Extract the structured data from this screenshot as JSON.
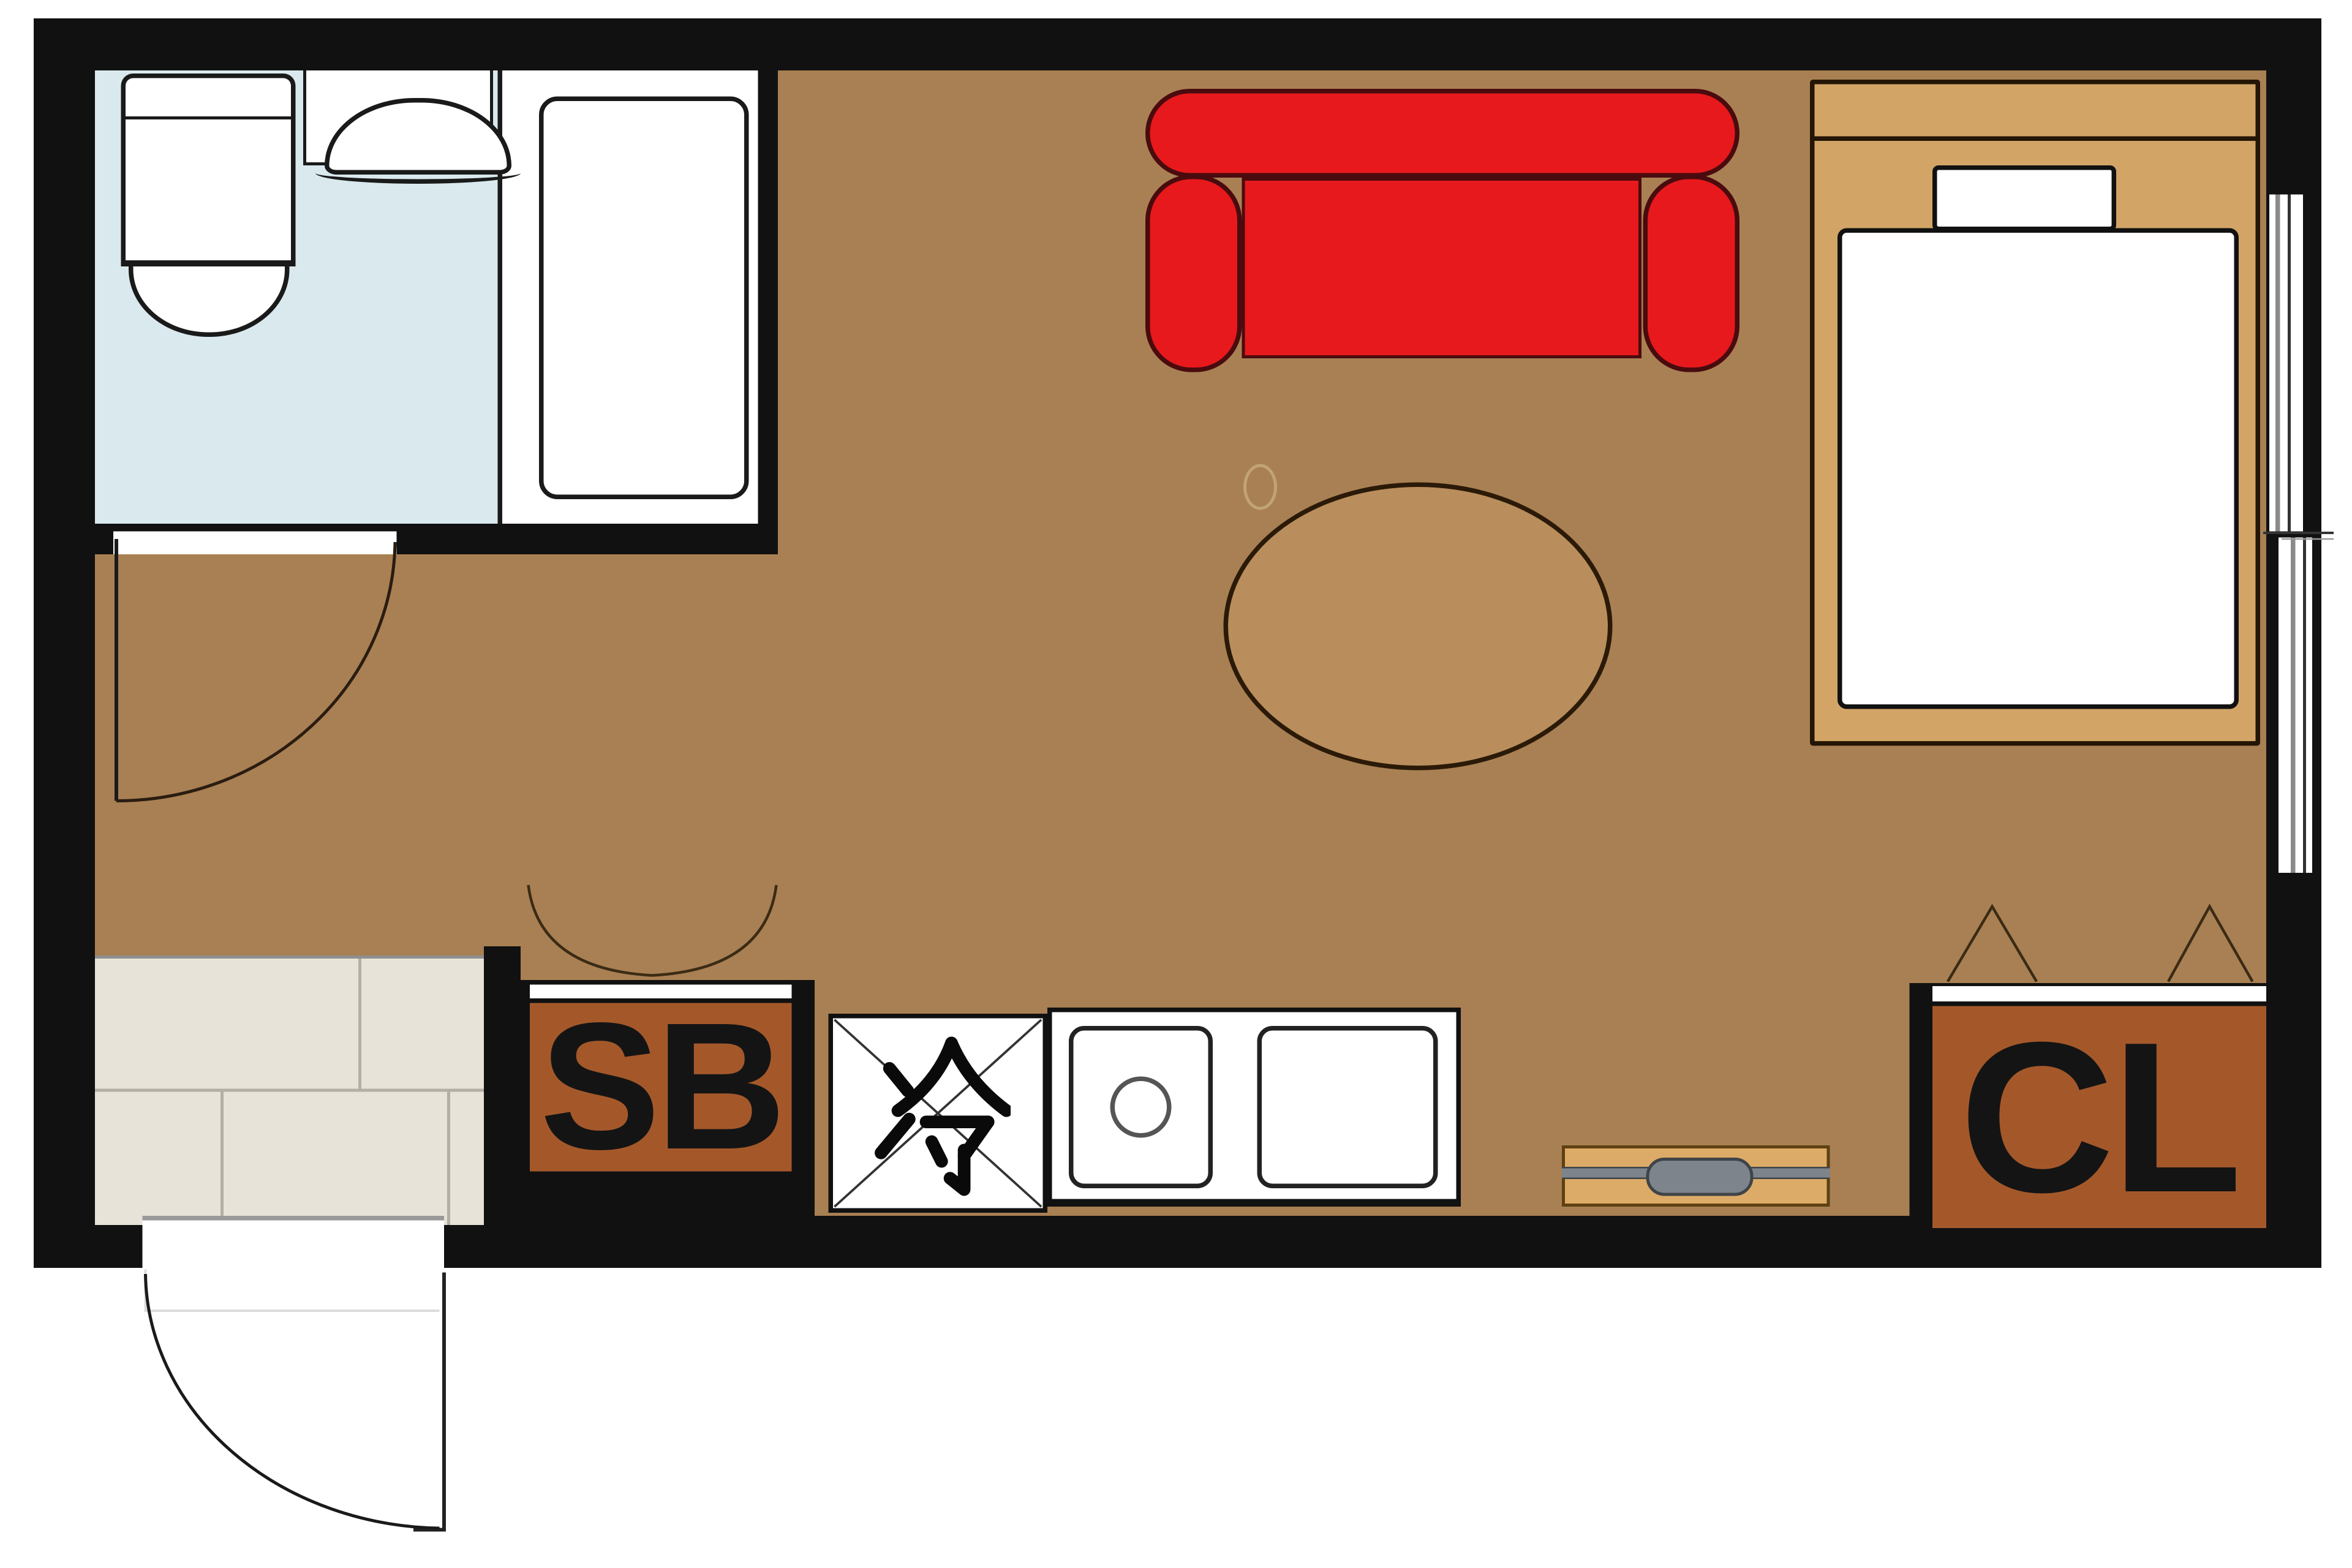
{
  "document": {
    "kind": "apartment-floor-plan",
    "rooms_visible": [
      "bathroom",
      "entrance-genkan",
      "kitchen",
      "main-room"
    ]
  },
  "labels": {
    "shoe_box": "SB",
    "closet": "CL",
    "refrigerator": "冷"
  },
  "palette": {
    "wall_black": "#111111",
    "wood_floor": "#a98053",
    "bathroom_floor_blue": "#d9e9ee",
    "entrance_tile_beige": "#e7e3d8",
    "sofa_red": "#e8191c",
    "cabinet_orange": "#a4582a",
    "bed_frame_tan": "#d2a567",
    "table_wood": "#b98e5c",
    "tv_board_tan": "#dcab67",
    "metal_gray": "#7d848b",
    "fixture_white": "#ffffff"
  },
  "fixtures": {
    "bathroom": [
      "toilet",
      "washbasin",
      "bathtub",
      "hinged-door"
    ],
    "kitchen": [
      "refrigerator-space",
      "stove-burner",
      "sink",
      "double-swing-door"
    ],
    "main_room": [
      "sofa",
      "oval-table",
      "single-bed",
      "pillow",
      "tv-board",
      "sliding-window"
    ],
    "entrance": [
      "tiled-genkan",
      "entry-door",
      "shoe-box"
    ],
    "closet": [
      "folding-doors"
    ]
  }
}
